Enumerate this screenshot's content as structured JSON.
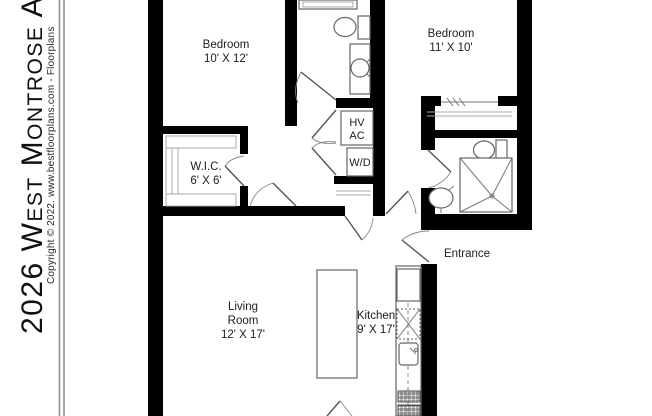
{
  "sidebar": {
    "title": "2026 West Montrose Avenue",
    "copyright": "Copyright © 2022. www.bestfloorplans.com - Floorplans"
  },
  "plan": {
    "bedroom1": {
      "name": "Bedroom",
      "dims": "10' X 12'"
    },
    "bedroom2": {
      "name": "Bedroom",
      "dims": "11' X 10'"
    },
    "wic": {
      "name": "W.I.C.",
      "dims": "6' X 6'"
    },
    "living_room": {
      "name_line1": "Living",
      "name_line2": "Room",
      "dims": "12' X 17'"
    },
    "kitchen": {
      "name": "Kitchen",
      "dims": "9' X 17'"
    },
    "entrance_label": "Entrance",
    "hvac_line1": "HV",
    "hvac_line2": "AC",
    "washer_dryer_label": "W/D"
  },
  "colors": {
    "wall": "#000000",
    "fixture_line": "#666666",
    "label_text": "#1d1d1d"
  }
}
